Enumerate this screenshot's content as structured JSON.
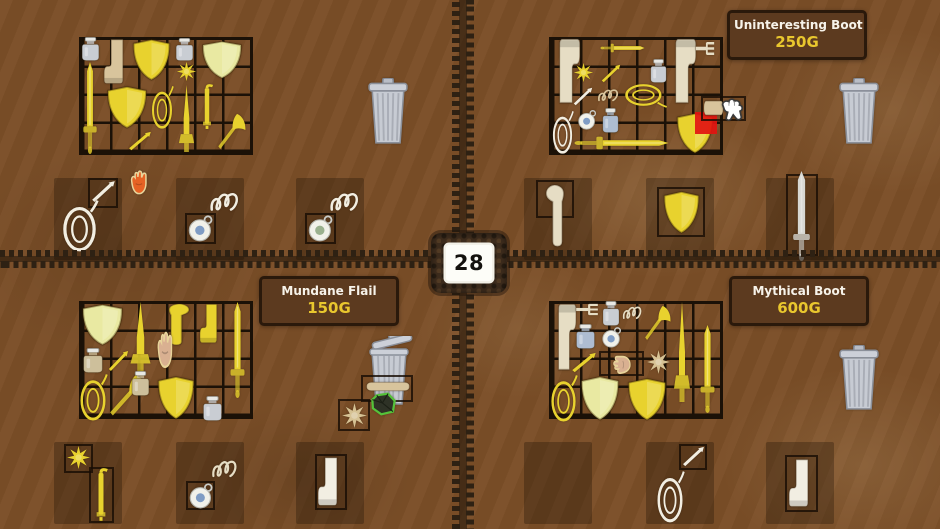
{
  "palette": {
    "gold": "#e8d22e",
    "paleGold": "#e9e9a2",
    "tan": "#d8c49c",
    "pinkTan": "#d9b091",
    "pale": "#e6ddc4",
    "white": "#f2eee2",
    "greyJar": "#c9cdd3",
    "blueGrey": "#aebdd2",
    "tanJar": "#cdbf9b",
    "orange": "#e66224",
    "silver": "#d8d8d3",
    "blue": "#7f9cc4",
    "sage": "#9ab08e",
    "paleStar": "#d6c294",
    "background": "#7b4e27",
    "grid_line": "#1b1107",
    "tooltip_bg": "#5c3a1f",
    "tooltip_border": "#2a190b",
    "price_gold": "#e9c72e",
    "highlight_red": "#e21410"
  },
  "center_badge": {
    "value": "28"
  },
  "quadrants": {
    "top_left": {
      "tooltip": null,
      "grid": {
        "x": 79,
        "y": 37,
        "cols": 6,
        "rows": 4
      },
      "trash": {
        "x": 367,
        "y": 78,
        "w": 42,
        "h": 67,
        "open": false
      },
      "slots": [
        {
          "x": 54,
          "y": 178,
          "w": 68,
          "h": 82
        },
        {
          "x": 176,
          "y": 178,
          "w": 68,
          "h": 82
        },
        {
          "x": 296,
          "y": 178,
          "w": 68,
          "h": 82
        }
      ],
      "items": [
        {
          "t": "jar",
          "c": "greyJar",
          "x": 78,
          "y": 37,
          "w": 25,
          "h": 24
        },
        {
          "t": "boot",
          "c": "tan",
          "x": 103,
          "y": 38,
          "w": 28,
          "h": 47,
          "f": true
        },
        {
          "t": "shield",
          "c": "gold",
          "x": 129,
          "y": 37,
          "w": 45,
          "h": 45
        },
        {
          "t": "jar",
          "c": "greyJar",
          "x": 172,
          "y": 38,
          "w": 25,
          "h": 23
        },
        {
          "t": "shield",
          "c": "paleGold",
          "x": 198,
          "y": 39,
          "w": 48,
          "h": 41
        },
        {
          "t": "mace",
          "c": "gold",
          "x": 176,
          "y": 61,
          "w": 21,
          "h": 21
        },
        {
          "t": "sword",
          "c": "gold",
          "x": 80,
          "y": 62,
          "w": 20,
          "h": 92
        },
        {
          "t": "shield",
          "c": "gold",
          "x": 103,
          "y": 84,
          "w": 48,
          "h": 46
        },
        {
          "t": "lasso",
          "c": "gold",
          "x": 150,
          "y": 85,
          "w": 24,
          "h": 45
        },
        {
          "t": "dagger",
          "c": "gold",
          "x": 177,
          "y": 85,
          "w": 19,
          "h": 67
        },
        {
          "t": "flail",
          "c": "gold",
          "x": 198,
          "y": 84,
          "w": 18,
          "h": 46
        },
        {
          "t": "axe",
          "c": "gold",
          "x": 216,
          "y": 111,
          "w": 31,
          "h": 41
        },
        {
          "t": "needle",
          "c": "gold",
          "x": 127,
          "y": 130,
          "w": 26,
          "h": 22
        },
        {
          "t": "hand",
          "c": "orange",
          "x": 127,
          "y": 168,
          "w": 26,
          "h": 29
        },
        {
          "t": "box",
          "x": 88,
          "y": 178,
          "w": 30,
          "h": 30
        },
        {
          "t": "needle",
          "c": "white",
          "x": 90,
          "y": 179,
          "w": 27,
          "h": 25
        },
        {
          "t": "lasso",
          "c": "white",
          "x": 60,
          "y": 199,
          "w": 39,
          "h": 54
        },
        {
          "t": "squiggle",
          "c": "white",
          "x": 209,
          "y": 188,
          "w": 33,
          "h": 27
        },
        {
          "t": "box",
          "x": 185,
          "y": 213,
          "w": 31,
          "h": 31
        },
        {
          "t": "whistle",
          "c": "blue",
          "x": 187,
          "y": 214,
          "w": 28,
          "h": 28
        },
        {
          "t": "squiggle",
          "c": "white",
          "x": 329,
          "y": 188,
          "w": 33,
          "h": 27
        },
        {
          "t": "box",
          "x": 305,
          "y": 213,
          "w": 31,
          "h": 31
        },
        {
          "t": "whistle",
          "c": "sage",
          "x": 307,
          "y": 214,
          "w": 28,
          "h": 28
        }
      ]
    },
    "top_right": {
      "tooltip": {
        "title": "Uninteresting Boot",
        "price": "250G"
      },
      "grid": {
        "x": 549,
        "y": 37,
        "cols": 6,
        "rows": 4
      },
      "trash": {
        "x": 838,
        "y": 78,
        "w": 42,
        "h": 67,
        "open": false
      },
      "slots": [
        {
          "x": 524,
          "y": 178,
          "w": 68,
          "h": 82
        },
        {
          "x": 646,
          "y": 178,
          "w": 68,
          "h": 82
        },
        {
          "x": 766,
          "y": 178,
          "w": 68,
          "h": 82
        }
      ],
      "items": [
        {
          "t": "boot",
          "c": "pale",
          "x": 551,
          "y": 37,
          "w": 30,
          "h": 68,
          "r": 180,
          "f": true
        },
        {
          "t": "sword",
          "c": "gold",
          "x": 616,
          "y": 26,
          "w": 13,
          "h": 44,
          "r": 90
        },
        {
          "t": "boot",
          "c": "pale",
          "x": 667,
          "y": 37,
          "w": 30,
          "h": 68,
          "r": 180,
          "f": true
        },
        {
          "t": "fork",
          "c": "pale",
          "x": 694,
          "y": 41,
          "w": 22,
          "h": 15
        },
        {
          "t": "mace",
          "c": "gold",
          "x": 573,
          "y": 62,
          "w": 21,
          "h": 21
        },
        {
          "t": "needle",
          "c": "gold",
          "x": 600,
          "y": 63,
          "w": 22,
          "h": 21
        },
        {
          "t": "lasso",
          "c": "gold",
          "x": 633,
          "y": 73,
          "w": 26,
          "h": 44,
          "r": 90
        },
        {
          "t": "jar",
          "c": "greyJar",
          "x": 647,
          "y": 59,
          "w": 23,
          "h": 24
        },
        {
          "t": "needle",
          "c": "white",
          "x": 572,
          "y": 86,
          "w": 22,
          "h": 21
        },
        {
          "t": "squiggle",
          "c": "tan",
          "x": 597,
          "y": 86,
          "w": 24,
          "h": 18
        },
        {
          "t": "lasso",
          "c": "white",
          "x": 551,
          "y": 110,
          "w": 23,
          "h": 45
        },
        {
          "t": "whistle",
          "c": "blue",
          "x": 577,
          "y": 109,
          "w": 21,
          "h": 21
        },
        {
          "t": "jar",
          "c": "blueGrey",
          "x": 599,
          "y": 108,
          "w": 23,
          "h": 25
        },
        {
          "t": "shield",
          "c": "gold",
          "x": 673,
          "y": 111,
          "w": 44,
          "h": 44
        },
        {
          "t": "red",
          "x": 695,
          "y": 112,
          "w": 22,
          "h": 22
        },
        {
          "t": "sword",
          "c": "gold",
          "x": 612,
          "y": 96,
          "w": 19,
          "h": 94,
          "r": 90
        },
        {
          "t": "box",
          "x": 701,
          "y": 96,
          "w": 45,
          "h": 25
        },
        {
          "t": "slab",
          "c": "tan",
          "x": 705,
          "y": 98,
          "w": 17,
          "h": 20,
          "r": 90
        },
        {
          "t": "cursor",
          "x": 716,
          "y": 96,
          "w": 32,
          "h": 28
        },
        {
          "t": "box",
          "x": 536,
          "y": 180,
          "w": 38,
          "h": 38
        },
        {
          "t": "hook",
          "c": "pale",
          "x": 540,
          "y": 182,
          "w": 38,
          "h": 66
        },
        {
          "t": "box",
          "x": 657,
          "y": 187,
          "w": 48,
          "h": 50
        },
        {
          "t": "shield",
          "c": "gold",
          "x": 660,
          "y": 189,
          "w": 43,
          "h": 46
        },
        {
          "t": "box",
          "x": 786,
          "y": 174,
          "w": 32,
          "h": 82
        },
        {
          "t": "sword",
          "c": "silver",
          "x": 789,
          "y": 171,
          "w": 25,
          "h": 90
        }
      ]
    },
    "bottom_left": {
      "tooltip": {
        "title": "Mundane Flail",
        "price": "150G"
      },
      "grid": {
        "x": 79,
        "y": 301,
        "cols": 6,
        "rows": 4
      },
      "trash": {
        "x": 363,
        "y": 336,
        "w": 52,
        "h": 70,
        "open": true
      },
      "slots": [
        {
          "x": 54,
          "y": 442,
          "w": 68,
          "h": 82
        },
        {
          "x": 176,
          "y": 442,
          "w": 68,
          "h": 82
        },
        {
          "x": 296,
          "y": 442,
          "w": 68,
          "h": 82
        }
      ],
      "items": [
        {
          "t": "shield",
          "c": "paleGold",
          "x": 78,
          "y": 302,
          "w": 49,
          "h": 45
        },
        {
          "t": "dagger",
          "c": "gold",
          "x": 128,
          "y": 302,
          "w": 25,
          "h": 71
        },
        {
          "t": "hook",
          "c": "gold",
          "x": 153,
          "y": 302,
          "w": 43,
          "h": 44,
          "f": true
        },
        {
          "t": "hand",
          "c": "pinkTan",
          "x": 154,
          "y": 328,
          "w": 24,
          "h": 44
        },
        {
          "t": "boot",
          "c": "gold",
          "x": 199,
          "y": 303,
          "w": 25,
          "h": 41,
          "f": true
        },
        {
          "t": "sword",
          "c": "gold",
          "x": 227,
          "y": 302,
          "w": 21,
          "h": 96
        },
        {
          "t": "jar",
          "c": "tanJar",
          "x": 79,
          "y": 348,
          "w": 28,
          "h": 25
        },
        {
          "t": "needle",
          "c": "gold",
          "x": 107,
          "y": 349,
          "w": 23,
          "h": 24
        },
        {
          "t": "lasso",
          "c": "gold",
          "x": 78,
          "y": 373,
          "w": 30,
          "h": 49
        },
        {
          "t": "axe",
          "c": "gold",
          "x": 107,
          "y": 372,
          "w": 42,
          "h": 47
        },
        {
          "t": "jar",
          "c": "tanJar",
          "x": 128,
          "y": 371,
          "w": 25,
          "h": 25
        },
        {
          "t": "shield",
          "c": "gold",
          "x": 154,
          "y": 374,
          "w": 44,
          "h": 47
        },
        {
          "t": "jar",
          "c": "greyJar",
          "x": 199,
          "y": 396,
          "w": 27,
          "h": 25
        },
        {
          "t": "box",
          "x": 361,
          "y": 375,
          "w": 52,
          "h": 27
        },
        {
          "t": "slab",
          "c": "tan",
          "x": 383,
          "y": 364,
          "w": 10,
          "h": 45,
          "r": 90
        },
        {
          "t": "rock",
          "x": 369,
          "y": 391,
          "w": 29,
          "h": 26
        },
        {
          "t": "box",
          "x": 338,
          "y": 399,
          "w": 32,
          "h": 32
        },
        {
          "t": "mace",
          "c": "paleStar",
          "x": 341,
          "y": 402,
          "w": 27,
          "h": 27
        },
        {
          "t": "box",
          "x": 64,
          "y": 444,
          "w": 29,
          "h": 29
        },
        {
          "t": "mace",
          "c": "gold",
          "x": 66,
          "y": 445,
          "w": 25,
          "h": 25
        },
        {
          "t": "box",
          "x": 89,
          "y": 467,
          "w": 25,
          "h": 56
        },
        {
          "t": "flail",
          "c": "gold",
          "x": 91,
          "y": 468,
          "w": 20,
          "h": 54
        },
        {
          "t": "squiggle",
          "c": "pale",
          "x": 211,
          "y": 456,
          "w": 29,
          "h": 25
        },
        {
          "t": "box",
          "x": 186,
          "y": 481,
          "w": 29,
          "h": 29
        },
        {
          "t": "whistle",
          "c": "blue",
          "x": 188,
          "y": 482,
          "w": 27,
          "h": 27
        },
        {
          "t": "box",
          "x": 315,
          "y": 454,
          "w": 32,
          "h": 56
        },
        {
          "t": "boot",
          "c": "white",
          "x": 317,
          "y": 456,
          "w": 28,
          "h": 51,
          "f": true
        }
      ]
    },
    "bottom_right": {
      "tooltip": {
        "title": "Mythical Boot",
        "price": "600G"
      },
      "grid": {
        "x": 549,
        "y": 301,
        "cols": 6,
        "rows": 4
      },
      "trash": {
        "x": 838,
        "y": 345,
        "w": 42,
        "h": 66,
        "open": false
      },
      "slots": [
        {
          "x": 524,
          "y": 442,
          "w": 68,
          "h": 82
        },
        {
          "x": 646,
          "y": 442,
          "w": 68,
          "h": 82
        },
        {
          "x": 766,
          "y": 442,
          "w": 68,
          "h": 82
        }
      ],
      "items": [
        {
          "t": "boot",
          "c": "pale",
          "x": 551,
          "y": 302,
          "w": 26,
          "h": 70,
          "r": 180,
          "f": true
        },
        {
          "t": "fork",
          "c": "pale",
          "x": 574,
          "y": 303,
          "w": 26,
          "h": 13
        },
        {
          "t": "jar",
          "c": "greyJar",
          "x": 599,
          "y": 301,
          "w": 24,
          "h": 25
        },
        {
          "t": "squiggle",
          "c": "pale",
          "x": 622,
          "y": 303,
          "w": 22,
          "h": 19
        },
        {
          "t": "axe",
          "c": "gold",
          "x": 643,
          "y": 303,
          "w": 29,
          "h": 40
        },
        {
          "t": "jar",
          "c": "blueGrey",
          "x": 572,
          "y": 324,
          "w": 27,
          "h": 25
        },
        {
          "t": "whistle",
          "c": "blue",
          "x": 601,
          "y": 326,
          "w": 22,
          "h": 22
        },
        {
          "t": "needle",
          "c": "gold",
          "x": 570,
          "y": 351,
          "w": 28,
          "h": 23
        },
        {
          "t": "box",
          "x": 599,
          "y": 351,
          "w": 45,
          "h": 25
        },
        {
          "t": "hand",
          "c": "pinkTan",
          "x": 607,
          "y": 353,
          "w": 30,
          "h": 21,
          "r": -90
        },
        {
          "t": "mace",
          "c": "paleStar",
          "x": 646,
          "y": 349,
          "w": 25,
          "h": 26
        },
        {
          "t": "dagger",
          "c": "gold",
          "x": 672,
          "y": 302,
          "w": 20,
          "h": 100
        },
        {
          "t": "sword",
          "c": "gold",
          "x": 697,
          "y": 325,
          "w": 21,
          "h": 88
        },
        {
          "t": "lasso",
          "c": "gold",
          "x": 549,
          "y": 374,
          "w": 29,
          "h": 49
        },
        {
          "t": "shield",
          "c": "paleGold",
          "x": 577,
          "y": 374,
          "w": 46,
          "h": 48
        },
        {
          "t": "shield",
          "c": "gold",
          "x": 624,
          "y": 376,
          "w": 46,
          "h": 46
        },
        {
          "t": "box",
          "x": 679,
          "y": 444,
          "w": 28,
          "h": 26
        },
        {
          "t": "needle",
          "c": "white",
          "x": 681,
          "y": 445,
          "w": 25,
          "h": 23
        },
        {
          "t": "lasso",
          "c": "white",
          "x": 655,
          "y": 470,
          "w": 30,
          "h": 54
        },
        {
          "t": "box",
          "x": 785,
          "y": 455,
          "w": 33,
          "h": 57
        },
        {
          "t": "boot",
          "c": "white",
          "x": 788,
          "y": 458,
          "w": 28,
          "h": 50,
          "f": true
        }
      ]
    }
  }
}
